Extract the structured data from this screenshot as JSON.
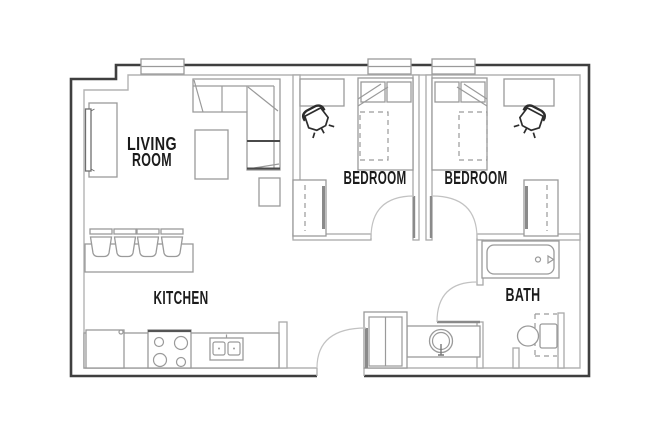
{
  "floor_plan": {
    "labels": {
      "living_room_line1": "LIVING",
      "living_room_line2": "ROOM",
      "bedroom_1": "BEDROOM",
      "bedroom_2": "BEDROOM",
      "kitchen": "KITCHEN",
      "bath": "BATH"
    },
    "rooms": [
      {
        "name": "Living Room",
        "furniture": [
          "sectional-sofa",
          "coffee-table",
          "side-table",
          "tv-console",
          "tv"
        ]
      },
      {
        "name": "Kitchen",
        "furniture": [
          "bar-counter",
          "bar-stool-x4",
          "refrigerator",
          "range-cooktop",
          "double-basin-sink",
          "base-counter"
        ]
      },
      {
        "name": "Bedroom 1",
        "furniture": [
          "bed",
          "pillow-x2",
          "under-bed-storage-dashed",
          "desk",
          "office-chair",
          "closet-with-sliding-door",
          "window"
        ]
      },
      {
        "name": "Bedroom 2",
        "furniture": [
          "bed",
          "pillow-x2",
          "under-bed-storage-dashed",
          "desk",
          "office-chair",
          "closet-with-sliding-door",
          "window"
        ]
      },
      {
        "name": "Bath",
        "furniture": [
          "bathtub",
          "toilet-with-clearance-dashed",
          "round-vanity-sink"
        ]
      },
      {
        "name": "Entry",
        "furniture": [
          "entry-door",
          "utility-closet-double-door"
        ]
      }
    ],
    "counts": {
      "bedrooms": 2,
      "bathrooms": 1,
      "windows": 3,
      "door_swings": 4,
      "bar_stools": 4
    },
    "colors": {
      "background": "#ffffff",
      "wall_outer": "#3f3f3f",
      "wall_inner": "#b3b3b3",
      "interior_wall": "#a9a9a9",
      "furniture_line": "#9a9a9a",
      "dark_accent": "#2d2d2d",
      "door_leaf": "#8a8a8a",
      "text": "#1b1b1b"
    }
  }
}
